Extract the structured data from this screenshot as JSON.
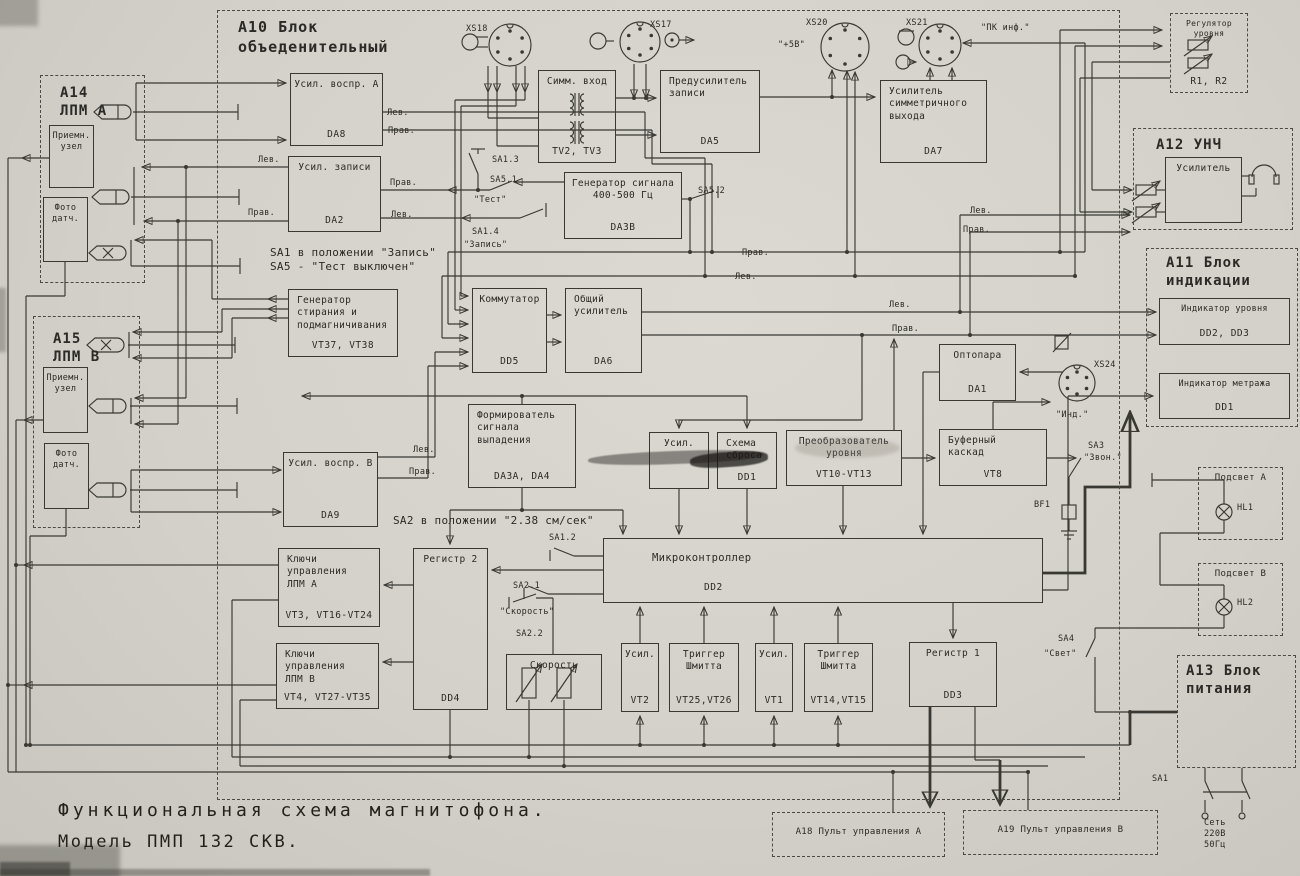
{
  "document": {
    "type": "scanned functional schematic",
    "title_line1": "Функциональная схема магнитофона.",
    "title_line2": "Модель ПМП 132 СКВ."
  },
  "colors": {
    "paper": "#d4d1ca",
    "ink": "#3a3833"
  },
  "diagram": {
    "blocks": [
      {
        "name": "usil-vospr-a",
        "label": "Усил. воспр. А",
        "ref": "DA8",
        "x": 290,
        "y": 73,
        "w": 93,
        "h": 73
      },
      {
        "name": "usil-zapisi",
        "label": "Усил. записи",
        "ref": "DA2",
        "x": 288,
        "y": 156,
        "w": 93,
        "h": 76
      },
      {
        "name": "simm-vhod",
        "label": "Симм. вход",
        "ref": "TV2, TV3",
        "x": 538,
        "y": 70,
        "w": 78,
        "h": 93
      },
      {
        "name": "predusilitel-zapisi",
        "label": "Предусилитель\nзаписи",
        "ref": "DA5",
        "x": 660,
        "y": 70,
        "w": 100,
        "h": 83,
        "cls": "left-label"
      },
      {
        "name": "usilitel-simm-vyhoda",
        "label": "Усилитель\nсимметричного\nвыхода",
        "ref": "DA7",
        "x": 880,
        "y": 80,
        "w": 107,
        "h": 83,
        "cls": "left-label"
      },
      {
        "name": "generator-signala",
        "label": "Генератор сигнала\n400-500 Гц",
        "ref": "DA3В",
        "x": 564,
        "y": 172,
        "w": 118,
        "h": 67
      },
      {
        "name": "generator-stiraniya",
        "label": "Генератор\nстирания и\nподмагничивания",
        "ref": "VT37, VT38",
        "x": 288,
        "y": 289,
        "w": 110,
        "h": 68,
        "cls": "left-label"
      },
      {
        "name": "kommutator",
        "label": "Коммутатор",
        "ref": "DD5",
        "x": 472,
        "y": 288,
        "w": 75,
        "h": 85
      },
      {
        "name": "obshchiy-usilitel",
        "label": "Общий\nусилитель",
        "ref": "DA6",
        "x": 565,
        "y": 288,
        "w": 77,
        "h": 85,
        "cls": "left-label"
      },
      {
        "name": "formirovatel-signala",
        "label": "Формирователь\nсигнала\nвыпадения",
        "ref": "DA3A, DA4",
        "x": 468,
        "y": 404,
        "w": 108,
        "h": 84,
        "cls": "left-label"
      },
      {
        "name": "usil-vypadeniya",
        "label": "Усил.",
        "ref": "",
        "x": 649,
        "y": 432,
        "w": 60,
        "h": 57
      },
      {
        "name": "shema-sbrosa",
        "label": "Схема\nсброса",
        "ref": "DD1",
        "x": 717,
        "y": 432,
        "w": 60,
        "h": 57,
        "cls": "left-label"
      },
      {
        "name": "preobrazovatel-urovnya",
        "label": "Преобразователь\nуровня",
        "ref": "VT10-VT13",
        "x": 786,
        "y": 430,
        "w": 116,
        "h": 56
      },
      {
        "name": "optopara",
        "label": "Оптопара",
        "ref": "DA1",
        "x": 939,
        "y": 344,
        "w": 77,
        "h": 57
      },
      {
        "name": "bufernyj-kaskad",
        "label": "Буферный\nкаскад",
        "ref": "VT8",
        "x": 939,
        "y": 429,
        "w": 108,
        "h": 57,
        "cls": "left-label"
      },
      {
        "name": "mikrokontroller",
        "label": "Микроконтроллер",
        "ref": "DD2",
        "x": 603,
        "y": 538,
        "w": 440,
        "h": 65,
        "cls": "mc"
      },
      {
        "name": "registr-2",
        "label": "Регистр 2",
        "ref": "DD4",
        "x": 413,
        "y": 548,
        "w": 75,
        "h": 162
      },
      {
        "name": "klyuchi-lpm-a",
        "label": "Ключи\nуправления\nЛПМ А",
        "ref": "VT3, VT16-VT24",
        "x": 278,
        "y": 548,
        "w": 102,
        "h": 79,
        "cls": "left-label"
      },
      {
        "name": "klyuchi-lpm-b",
        "label": "Ключи\nуправления\nЛПМ В",
        "ref": "VT4, VT27-VT35",
        "x": 276,
        "y": 643,
        "w": 103,
        "h": 66,
        "cls": "left-label"
      },
      {
        "name": "skorost-block",
        "label": "Скорость",
        "ref": "",
        "x": 506,
        "y": 654,
        "w": 96,
        "h": 56
      },
      {
        "name": "usil-vt2",
        "label": "Усил.",
        "ref": "VT2",
        "x": 621,
        "y": 643,
        "w": 38,
        "h": 69
      },
      {
        "name": "trigger-shmitta-a",
        "label": "Триггер\nШмитта",
        "ref": "VT25,VT26",
        "x": 669,
        "y": 643,
        "w": 70,
        "h": 69
      },
      {
        "name": "usil-vt1",
        "label": "Усил.",
        "ref": "VT1",
        "x": 755,
        "y": 643,
        "w": 38,
        "h": 69
      },
      {
        "name": "trigger-shmitta-b",
        "label": "Триггер\nШмитта",
        "ref": "VT14,VT15",
        "x": 804,
        "y": 643,
        "w": 69,
        "h": 69
      },
      {
        "name": "registr-1",
        "label": "Регистр 1",
        "ref": "DD3",
        "x": 909,
        "y": 642,
        "w": 88,
        "h": 65
      },
      {
        "name": "usilitel-unch",
        "label": "Усилитель",
        "ref": "",
        "x": 1165,
        "y": 157,
        "w": 77,
        "h": 66
      },
      {
        "name": "indikator-urovnya",
        "label": "Индикатор уровня",
        "ref": "DD2, DD3",
        "x": 1159,
        "y": 298,
        "w": 131,
        "h": 47,
        "fs": 8.5
      },
      {
        "name": "indikator-metrazha",
        "label": "Индикатор метража",
        "ref": "DD1",
        "x": 1159,
        "y": 373,
        "w": 131,
        "h": 46,
        "fs": 8.5
      },
      {
        "name": "priemnyj-uzel-a",
        "label": "Приемн.\nузел",
        "ref": "",
        "x": 49,
        "y": 125,
        "w": 45,
        "h": 63,
        "fs": 8.5
      },
      {
        "name": "foto-datchik-a",
        "label": "Фото\nдатч.",
        "ref": "",
        "x": 43,
        "y": 197,
        "w": 45,
        "h": 65,
        "fs": 8.5
      },
      {
        "name": "priemnyj-uzel-b",
        "label": "Приемн.\nузел",
        "ref": "",
        "x": 43,
        "y": 367,
        "w": 45,
        "h": 66,
        "fs": 8.5
      },
      {
        "name": "foto-datchik-b",
        "label": "Фото\nдатч.",
        "ref": "",
        "x": 44,
        "y": 443,
        "w": 45,
        "h": 66,
        "fs": 8.5
      },
      {
        "name": "usil-vospr-b",
        "label": "Усил. воспр. В",
        "ref": "DA9",
        "x": 283,
        "y": 452,
        "w": 95,
        "h": 75
      },
      {
        "name": "blok-a10",
        "label": "",
        "ref": "",
        "x": 217,
        "y": 10,
        "w": 903,
        "h": 790,
        "style": "dashed"
      },
      {
        "name": "blok-a14",
        "label": "",
        "ref": "",
        "x": 40,
        "y": 75,
        "w": 105,
        "h": 208,
        "style": "dashed"
      },
      {
        "name": "blok-a15",
        "label": "",
        "ref": "",
        "x": 33,
        "y": 316,
        "w": 107,
        "h": 212,
        "style": "dashed"
      },
      {
        "name": "regulyator-urovnya",
        "label": "Регулятор\nуровня",
        "ref": "R1, R2",
        "x": 1170,
        "y": 13,
        "w": 78,
        "h": 80,
        "style": "dashed",
        "fs": 8
      },
      {
        "name": "blok-a12",
        "label": "",
        "ref": "",
        "x": 1133,
        "y": 128,
        "w": 160,
        "h": 102,
        "style": "dashed"
      },
      {
        "name": "blok-a11",
        "label": "",
        "ref": "",
        "x": 1146,
        "y": 248,
        "w": 152,
        "h": 179,
        "style": "dashed"
      },
      {
        "name": "podsvet-a",
        "label": "Подсвет А",
        "ref": "",
        "x": 1198,
        "y": 467,
        "w": 85,
        "h": 73,
        "style": "dashed",
        "fs": 9
      },
      {
        "name": "podsvet-b",
        "label": "Подсвет В",
        "ref": "",
        "x": 1198,
        "y": 563,
        "w": 85,
        "h": 73,
        "style": "dashed",
        "fs": 9
      },
      {
        "name": "blok-a13",
        "label": "",
        "ref": "",
        "x": 1177,
        "y": 655,
        "w": 119,
        "h": 113,
        "style": "dashed"
      },
      {
        "name": "pult-upravleniya-a",
        "label": "А18  Пульт управления А",
        "ref": "",
        "x": 772,
        "y": 812,
        "w": 173,
        "h": 45,
        "style": "dashed",
        "fs": 9,
        "cls": "vcenter"
      },
      {
        "name": "pult-upravleniya-b",
        "label": "А19  Пульт управления В",
        "ref": "",
        "x": 963,
        "y": 810,
        "w": 195,
        "h": 45,
        "style": "dashed",
        "fs": 9,
        "cls": "vcenter"
      }
    ],
    "labels": [
      {
        "name": "label-a10",
        "text": "А10  Блок\nобъеденительный",
        "x": 238,
        "y": 18,
        "fs": 15,
        "cls": "big"
      },
      {
        "name": "label-a14",
        "text": "А14\nЛПМ А",
        "x": 60,
        "y": 84,
        "fs": 14,
        "cls": "big"
      },
      {
        "name": "label-a15",
        "text": "А15\nЛПМ В",
        "x": 53,
        "y": 330,
        "fs": 14,
        "cls": "big"
      },
      {
        "name": "label-a12",
        "text": "А12  УНЧ",
        "x": 1156,
        "y": 136,
        "fs": 14,
        "cls": "big"
      },
      {
        "name": "label-a11",
        "text": "А11  Блок\nиндикации",
        "x": 1166,
        "y": 254,
        "fs": 14,
        "cls": "big"
      },
      {
        "name": "label-a13",
        "text": "А13  Блок\nпитания",
        "x": 1186,
        "y": 662,
        "fs": 14,
        "cls": "big"
      },
      {
        "name": "label-xs18",
        "text": "XS18",
        "x": 466,
        "y": 24,
        "fs": 8.5
      },
      {
        "name": "label-xs17",
        "text": "XS17",
        "x": 650,
        "y": 20,
        "fs": 8.5
      },
      {
        "name": "label-xs20",
        "text": "XS20",
        "x": 806,
        "y": 18,
        "fs": 8.5
      },
      {
        "name": "label-xs21",
        "text": "XS21",
        "x": 906,
        "y": 18,
        "fs": 8.5
      },
      {
        "name": "label-plus5v",
        "text": "\"+5В\"",
        "x": 778,
        "y": 40,
        "fs": 8.5
      },
      {
        "name": "label-pk-inf",
        "text": "\"ПК инф.\"",
        "x": 981,
        "y": 23,
        "fs": 8.5
      },
      {
        "name": "label-xs24",
        "text": "XS24",
        "x": 1094,
        "y": 360,
        "fs": 8.5
      },
      {
        "name": "label-ind",
        "text": "\"Инд.\"",
        "x": 1056,
        "y": 410,
        "fs": 8.5
      },
      {
        "name": "label-lev-da8",
        "text": "Лев.",
        "x": 387,
        "y": 108,
        "fs": 8.5
      },
      {
        "name": "label-prav-da8",
        "text": "Прав.",
        "x": 388,
        "y": 126,
        "fs": 8.5
      },
      {
        "name": "label-lev-da2-out",
        "text": "Лев.",
        "x": 258,
        "y": 155,
        "fs": 8.5
      },
      {
        "name": "label-prav-da2-out",
        "text": "Прав.",
        "x": 248,
        "y": 208,
        "fs": 8.5
      },
      {
        "name": "label-prav-da2-in",
        "text": "Прав.",
        "x": 390,
        "y": 178,
        "fs": 8.5
      },
      {
        "name": "label-lev-da2-in",
        "text": "Лев.",
        "x": 391,
        "y": 210,
        "fs": 8.5
      },
      {
        "name": "label-sa1-3",
        "text": "SA1.3",
        "x": 492,
        "y": 155,
        "fs": 8.5
      },
      {
        "name": "label-sa5-1",
        "text": "SA5.1",
        "x": 490,
        "y": 175,
        "fs": 8.5
      },
      {
        "name": "label-test",
        "text": "\"Тест\"",
        "x": 474,
        "y": 195,
        "fs": 8.5
      },
      {
        "name": "label-sa1-4",
        "text": "SA1.4",
        "x": 472,
        "y": 227,
        "fs": 8.5
      },
      {
        "name": "label-zapis",
        "text": "\"Запись\"",
        "x": 464,
        "y": 240,
        "fs": 8.5
      },
      {
        "name": "note-sa1",
        "text": "SA1 в положении \"Запись\"\n SA5 - \"Тест выключен\"",
        "x": 270,
        "y": 246,
        "fs": 11
      },
      {
        "name": "label-sa5-2",
        "text": "SA5.2",
        "x": 698,
        "y": 186,
        "fs": 8.5
      },
      {
        "name": "label-prav-bus1",
        "text": "Прав.",
        "x": 742,
        "y": 248,
        "fs": 8.5
      },
      {
        "name": "label-lev-bus1",
        "text": "Лев.",
        "x": 735,
        "y": 272,
        "fs": 8.5
      },
      {
        "name": "label-lev-a12",
        "text": "Лев.",
        "x": 970,
        "y": 206,
        "fs": 8.5
      },
      {
        "name": "label-prav-a12",
        "text": "Прав.",
        "x": 963,
        "y": 225,
        "fs": 8.5
      },
      {
        "name": "label-lev-a11",
        "text": "Лев.",
        "x": 889,
        "y": 300,
        "fs": 8.5
      },
      {
        "name": "label-prav-a11",
        "text": "Прав.",
        "x": 892,
        "y": 324,
        "fs": 8.5
      },
      {
        "name": "label-lev-da9",
        "text": "Лев.",
        "x": 413,
        "y": 445,
        "fs": 8.5
      },
      {
        "name": "label-prav-da9",
        "text": "Прав.",
        "x": 409,
        "y": 467,
        "fs": 8.5
      },
      {
        "name": "note-sa2",
        "text": "SA2 в положении \"2.38 см/сек\"",
        "x": 393,
        "y": 514,
        "fs": 11
      },
      {
        "name": "label-sa1-2",
        "text": "SA1.2",
        "x": 549,
        "y": 533,
        "fs": 8.5
      },
      {
        "name": "label-sa2-1",
        "text": "SA2.1",
        "x": 513,
        "y": 581,
        "fs": 8.5
      },
      {
        "name": "label-skorost-q",
        "text": "\"Скорость\"",
        "x": 500,
        "y": 607,
        "fs": 8.5
      },
      {
        "name": "label-sa2-2",
        "text": "SA2.2",
        "x": 516,
        "y": 629,
        "fs": 8.5
      },
      {
        "name": "label-sa3",
        "text": "SA3",
        "x": 1088,
        "y": 441,
        "fs": 8.5
      },
      {
        "name": "label-zvon",
        "text": "\"Звон.\"",
        "x": 1084,
        "y": 453,
        "fs": 8.5
      },
      {
        "name": "label-bf1",
        "text": "BF1",
        "x": 1034,
        "y": 500,
        "fs": 8.5
      },
      {
        "name": "label-hl1",
        "text": "HL1",
        "x": 1237,
        "y": 503,
        "fs": 8.5
      },
      {
        "name": "label-hl2",
        "text": "HL2",
        "x": 1237,
        "y": 598,
        "fs": 8.5
      },
      {
        "name": "label-sa4",
        "text": "SA4",
        "x": 1058,
        "y": 634,
        "fs": 8.5
      },
      {
        "name": "label-svet",
        "text": "\"Свет\"",
        "x": 1044,
        "y": 649,
        "fs": 8.5
      },
      {
        "name": "label-sa1-power",
        "text": "SA1",
        "x": 1152,
        "y": 774,
        "fs": 8.5
      },
      {
        "name": "label-set-220",
        "text": "Сеть\n220В\n50Гц",
        "x": 1204,
        "y": 818,
        "fs": 8.5
      },
      {
        "name": "title-line1",
        "text": "Функциональная схема магнитофона.",
        "x": 58,
        "y": 799,
        "fs": 18,
        "cls": "title"
      },
      {
        "name": "title-line2",
        "text": "Модель ПМП 132 СКВ.",
        "x": 58,
        "y": 831,
        "fs": 17,
        "cls": "title2"
      }
    ]
  }
}
